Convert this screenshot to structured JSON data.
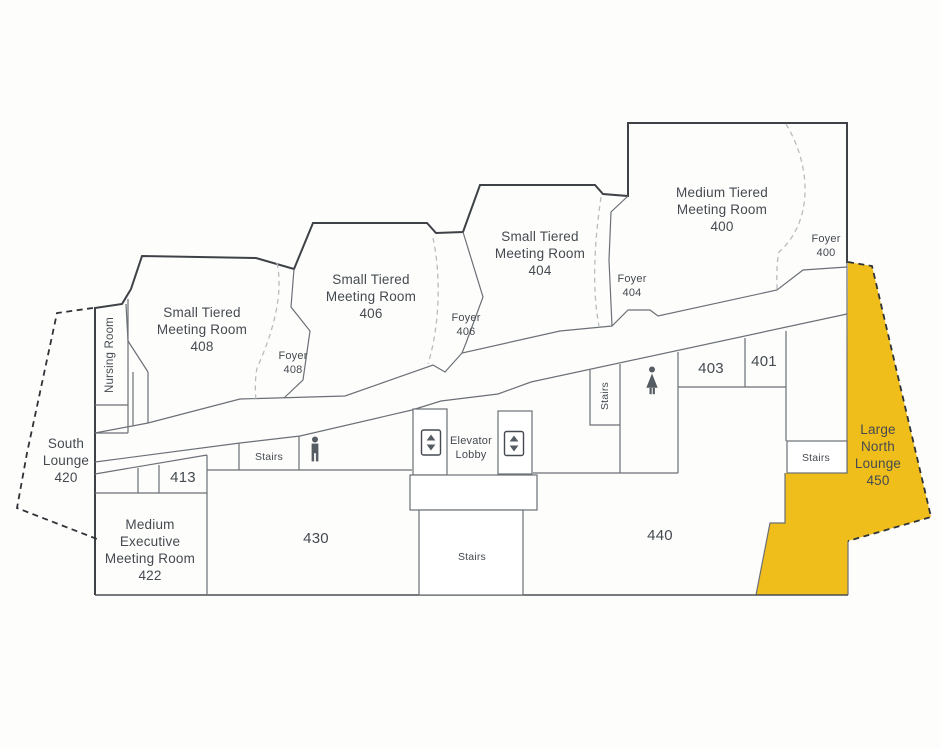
{
  "colors": {
    "highlight_yellow": "#EFBE1B",
    "wall_line": "#6b7076",
    "exterior_line": "#3e4247",
    "label_text": "#454a50"
  },
  "rooms": {
    "tiered_408": {
      "lines": [
        "Small Tiered",
        "Meeting Room",
        "408"
      ]
    },
    "tiered_406": {
      "lines": [
        "Small Tiered",
        "Meeting Room",
        "406"
      ]
    },
    "tiered_404": {
      "lines": [
        "Small Tiered",
        "Meeting Room",
        "404"
      ]
    },
    "tiered_400": {
      "lines": [
        "Medium Tiered",
        "Meeting Room",
        "400"
      ]
    },
    "foyer_408": {
      "lines": [
        "Foyer",
        "408"
      ]
    },
    "foyer_406": {
      "lines": [
        "Foyer",
        "406"
      ]
    },
    "foyer_404": {
      "lines": [
        "Foyer",
        "404"
      ]
    },
    "foyer_400": {
      "lines": [
        "Foyer",
        "400"
      ]
    },
    "nursing_room": {
      "label": "Nursing Room"
    },
    "south_lounge": {
      "lines": [
        "South",
        "Lounge",
        "420"
      ]
    },
    "exec_422": {
      "lines": [
        "Medium",
        "Executive",
        "Meeting Room",
        "422"
      ]
    },
    "room_413": {
      "label": "413"
    },
    "room_430": {
      "label": "430"
    },
    "room_440": {
      "label": "440"
    },
    "room_403": {
      "label": "403"
    },
    "room_401": {
      "label": "401"
    },
    "north_lounge": {
      "lines": [
        "Large",
        "North",
        "Lounge",
        "450"
      ]
    },
    "elevator_lobby": {
      "lines": [
        "Elevator",
        "Lobby"
      ]
    }
  },
  "labels": {
    "stairs": "Stairs"
  },
  "icons": {
    "mens_restroom": "person-male",
    "womens_restroom": "person-female",
    "elevator": "elevator-up-down-arrows"
  }
}
